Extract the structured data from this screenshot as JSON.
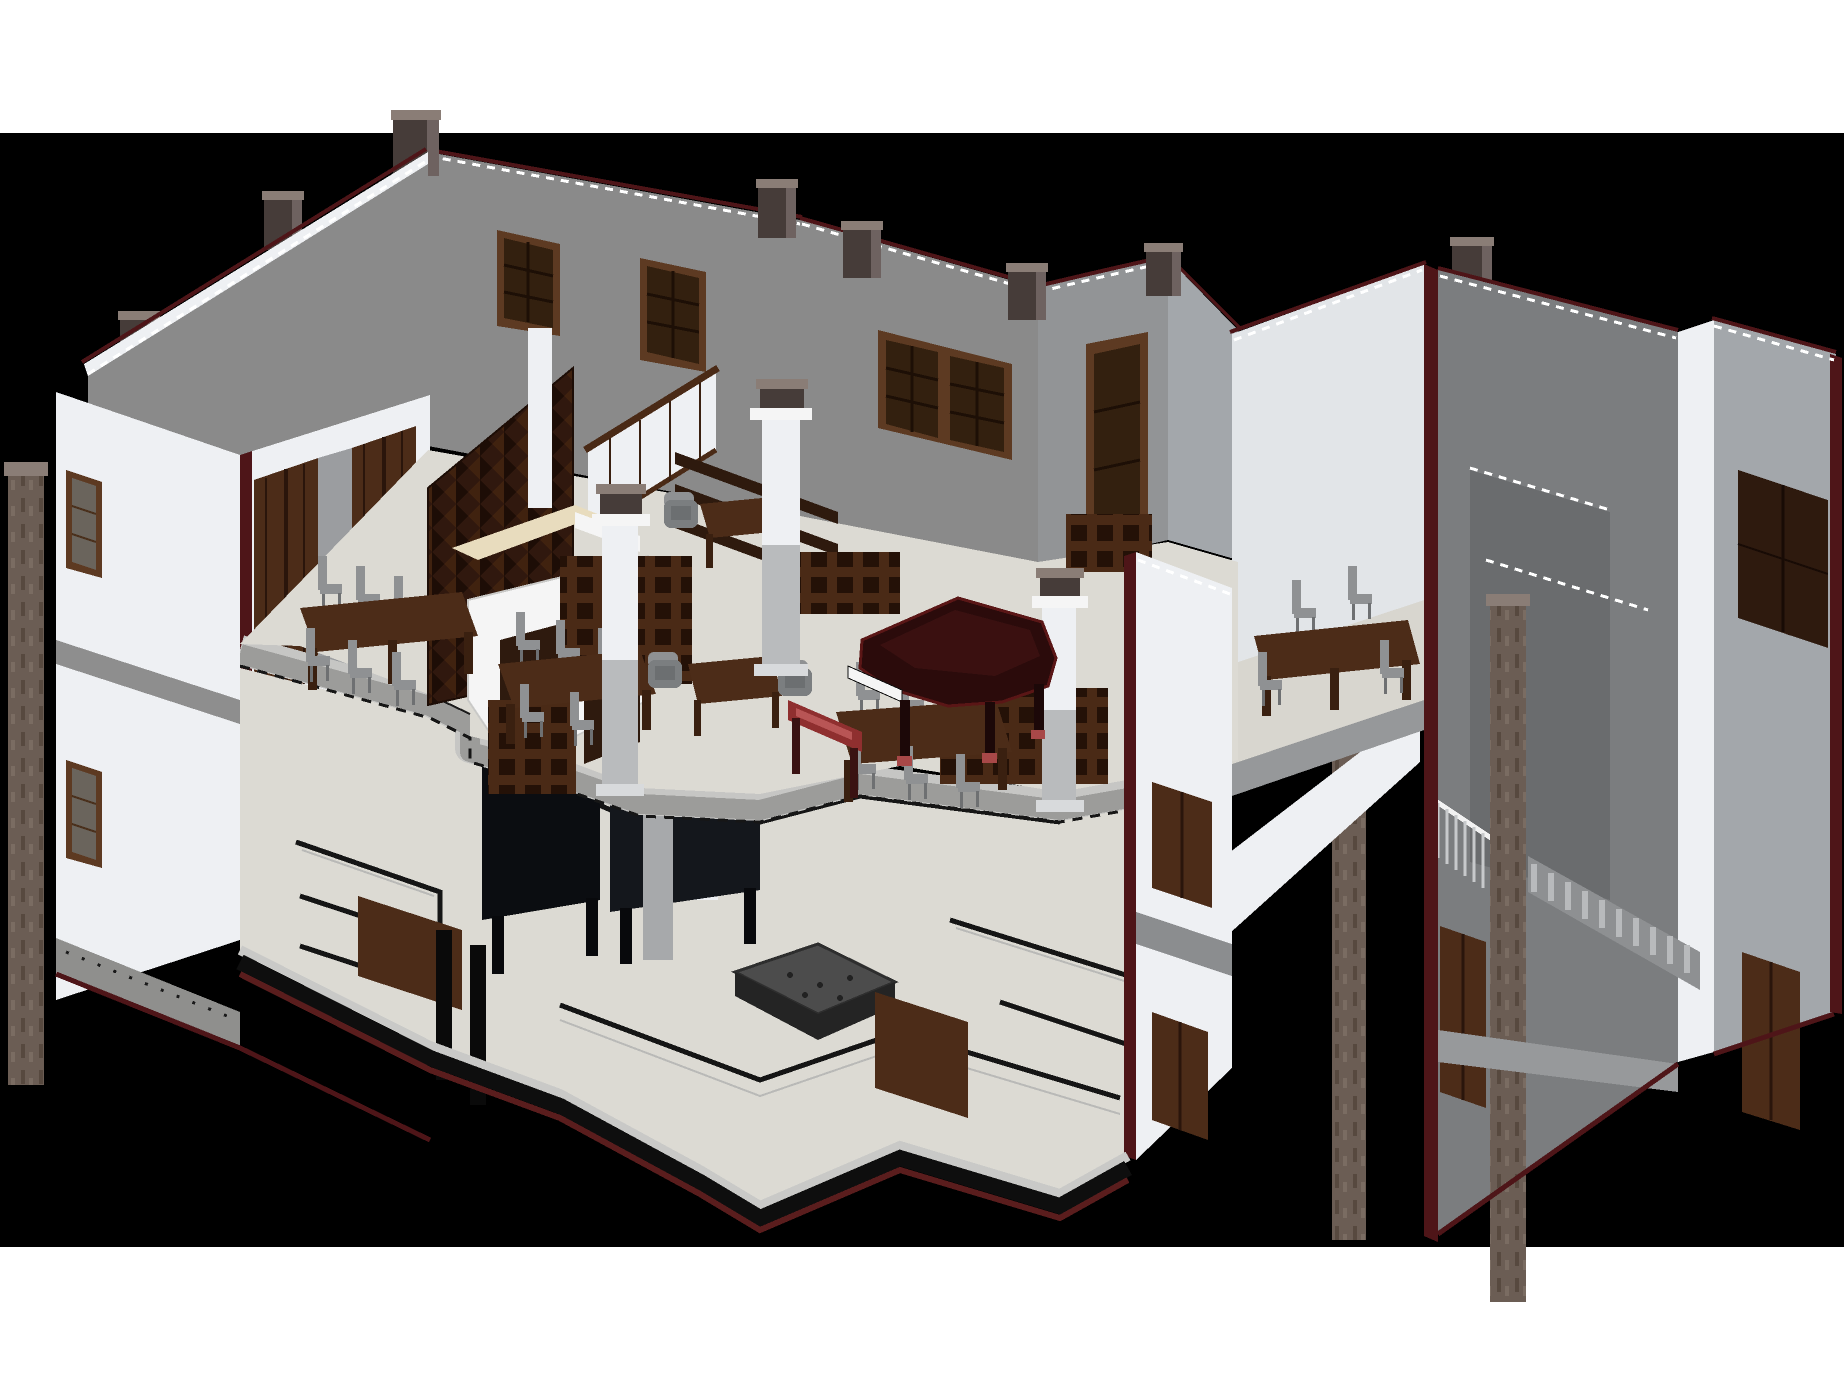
{
  "view": {
    "type": "3d-axonometric-cutaway-render",
    "page_background": "#ffffff",
    "viewport_background": "#000000",
    "viewport_top": 133,
    "viewport_bottom": 1247
  },
  "palette": {
    "page_bg": "#ffffff",
    "viewport_bg": "#000000",
    "wall_gray": "#8a8a8a",
    "wall_light": "#eef0f3",
    "wall_cut": "#7b7d7f",
    "floor": "#dcdad3",
    "slab": "#9c9c9a",
    "section_maroon": "#4e1518",
    "wood": "#4c2c18",
    "wood_dark": "#2e1a0e",
    "wine_rack": "#30180e",
    "counter_cream": "#e8dcbe",
    "counter_white": "#f5f5f5",
    "piano_body": "#2b0b0b",
    "piano_trim": "#5a1616",
    "bench_red": "#8f2f2f",
    "chair_gray": "#8f9193",
    "black_furniture": "#0b0d11",
    "stone_column": "#6b5d54",
    "fire_pit": "#4c4c4c"
  },
  "scene": {
    "building": "two-story residence shown as sectioned cutaway model",
    "floors_visible": 2,
    "objects": [
      "grand piano",
      "piano bench",
      "bar counter",
      "wine lattice rack",
      "wall shelves",
      "open cube bookshelves",
      "dining tables",
      "high-back chairs",
      "armchairs",
      "square columns with capitals",
      "stone pillars",
      "chimney blocks",
      "casement windows",
      "panel doors",
      "balcony railing",
      "staircase",
      "fire pit basin",
      "black service counters",
      "floor meander border"
    ]
  }
}
